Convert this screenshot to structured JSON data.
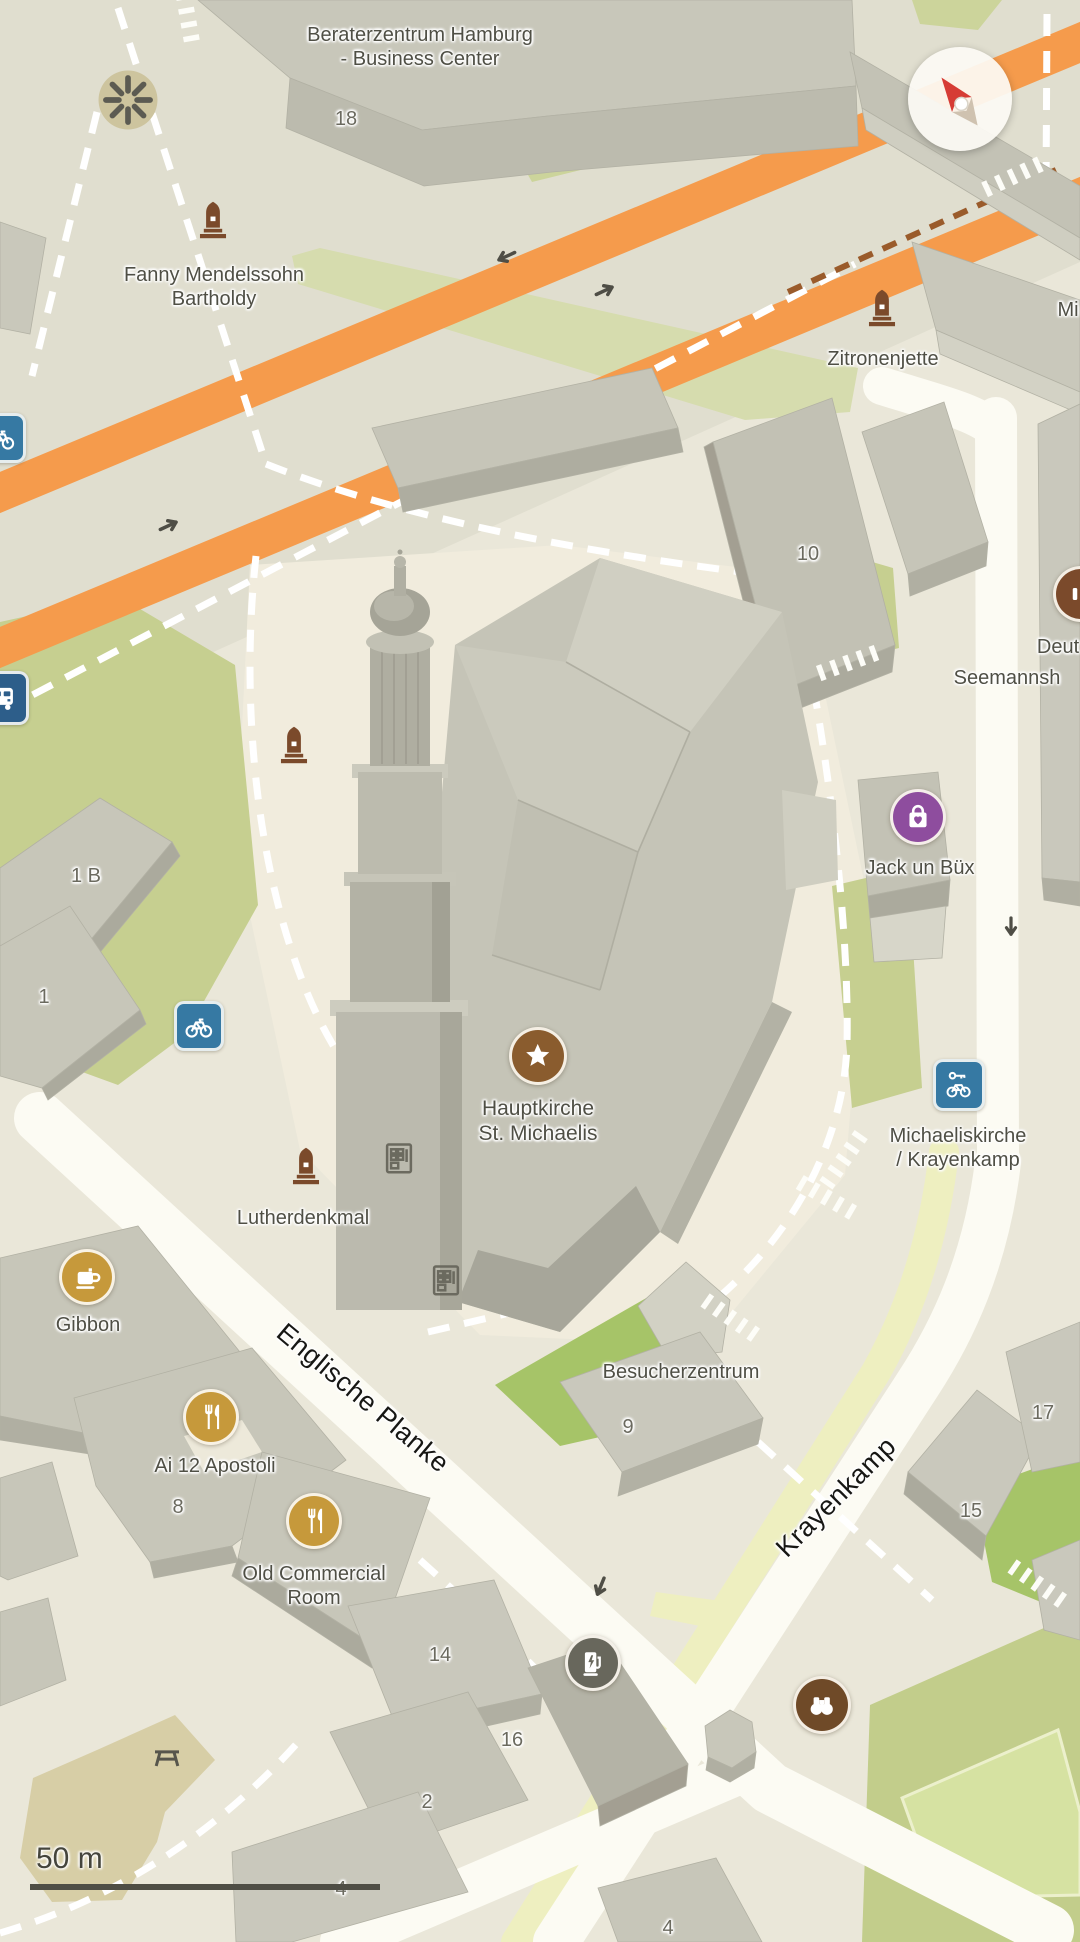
{
  "map": {
    "scale": {
      "label": "50 m"
    },
    "colors": {
      "background": "#EAE7D9",
      "plaza": "#F1ECDD",
      "road_corridor": "#E0DECF",
      "road_white": "#FCFBF3",
      "road_orange": "#F59B4C",
      "path_brown_dashed": "#9A5B2B",
      "green": "#C6CF90",
      "green_bright": "#A6C468",
      "green_field": "#C2CD8B",
      "bike_lane_yellow": "#EEEFC0",
      "building_roof": "#C9C8BB",
      "building_wall": "#B0AFA2",
      "poi_brown": "#8A5C2E",
      "poi_purple": "#8E4D9E",
      "poi_gold": "#C6993B",
      "poi_gray": "#68675C",
      "poi_darkbrown": "#6F4A28",
      "poi_blue": "#3679A3",
      "poi_busblue": "#2D5E8A",
      "memorial_brown": "#7B4A2B",
      "compass_red": "#D63C35"
    },
    "labels": [
      {
        "name": "label-beraterzentrum",
        "text": "Beraterzentrum Hamburg\n- Business Center",
        "x": 420,
        "y": 47,
        "size": 20
      },
      {
        "name": "label-fanny-mendelssohn",
        "text": "Fanny Mendelssohn\nBartholdy",
        "x": 214,
        "y": 287,
        "size": 20
      },
      {
        "name": "label-zitronenjette",
        "text": "Zitronenjette",
        "x": 883,
        "y": 359,
        "size": 20
      },
      {
        "name": "label-mi-partial",
        "text": "Mi",
        "x": 1068,
        "y": 310,
        "size": 20
      },
      {
        "name": "label-deut-partial",
        "text": "Deut",
        "x": 1058,
        "y": 647,
        "size": 20
      },
      {
        "name": "label-seemannsh-partial",
        "text": "Seemannsh",
        "x": 1007,
        "y": 678,
        "size": 20
      },
      {
        "name": "label-jack-un-buex",
        "text": "Jack un Büx",
        "x": 920,
        "y": 868,
        "size": 20
      },
      {
        "name": "label-hauptkirche",
        "text": "Hauptkirche\nSt. Michaelis",
        "x": 538,
        "y": 1121,
        "size": 21
      },
      {
        "name": "label-michaeliskirche",
        "text": "Michaeliskirche\n/ Krayenkamp",
        "x": 958,
        "y": 1148,
        "size": 20
      },
      {
        "name": "label-lutherdenkmal",
        "text": "Lutherdenkmal",
        "x": 303,
        "y": 1218,
        "size": 20
      },
      {
        "name": "label-gibbon",
        "text": "Gibbon",
        "x": 88,
        "y": 1325,
        "size": 20
      },
      {
        "name": "label-besucherzentrum",
        "text": "Besucherzentrum",
        "x": 681,
        "y": 1372,
        "size": 20
      },
      {
        "name": "label-ai-12-apostoli",
        "text": "Ai 12 Apostoli",
        "x": 215,
        "y": 1466,
        "size": 20
      },
      {
        "name": "label-old-commercial-room",
        "text": "Old Commercial\nRoom",
        "x": 314,
        "y": 1586,
        "size": 20
      },
      {
        "name": "street-englische-planke",
        "text": "Englische Planke",
        "x": 363,
        "y": 1398,
        "size": 27,
        "cls": "street",
        "rot": 40
      },
      {
        "name": "street-krayenkamp",
        "text": "Krayenkamp",
        "x": 836,
        "y": 1497,
        "size": 27,
        "cls": "street",
        "rot": -45
      },
      {
        "name": "number-18",
        "text": "18",
        "x": 346,
        "y": 119,
        "size": 20,
        "cls": "num"
      },
      {
        "name": "number-10",
        "text": "10",
        "x": 808,
        "y": 554,
        "size": 20,
        "cls": "num"
      },
      {
        "name": "number-1b",
        "text": "1 B",
        "x": 86,
        "y": 876,
        "size": 20,
        "cls": "num"
      },
      {
        "name": "number-1",
        "text": "1",
        "x": 44,
        "y": 997,
        "size": 20,
        "cls": "num"
      },
      {
        "name": "number-9",
        "text": "9",
        "x": 628,
        "y": 1427,
        "size": 20,
        "cls": "num"
      },
      {
        "name": "number-8",
        "text": "8",
        "x": 178,
        "y": 1507,
        "size": 20,
        "cls": "num"
      },
      {
        "name": "number-14",
        "text": "14",
        "x": 440,
        "y": 1655,
        "size": 20,
        "cls": "num"
      },
      {
        "name": "number-16",
        "text": "16",
        "x": 512,
        "y": 1740,
        "size": 20,
        "cls": "num"
      },
      {
        "name": "number-2",
        "text": "2",
        "x": 427,
        "y": 1802,
        "size": 20,
        "cls": "num"
      },
      {
        "name": "number-4a",
        "text": "4",
        "x": 341,
        "y": 1889,
        "size": 20,
        "cls": "num"
      },
      {
        "name": "number-4b",
        "text": "4",
        "x": 668,
        "y": 1928,
        "size": 20,
        "cls": "num"
      },
      {
        "name": "number-17",
        "text": "17",
        "x": 1043,
        "y": 1413,
        "size": 20,
        "cls": "num"
      },
      {
        "name": "number-15",
        "text": "15",
        "x": 971,
        "y": 1511,
        "size": 20,
        "cls": "num"
      }
    ],
    "pois": [
      {
        "name": "memorial-icon-fanny",
        "icon": "memorial",
        "kind": "plain",
        "color": "#7B4A2B",
        "x": 213,
        "y": 220,
        "size": 46
      },
      {
        "name": "memorial-icon-zitronenjette",
        "icon": "memorial",
        "kind": "plain",
        "color": "#7B4A2B",
        "x": 882,
        "y": 308,
        "size": 46
      },
      {
        "name": "memorial-icon-church-north",
        "icon": "memorial",
        "kind": "plain",
        "color": "#7B4A2B",
        "x": 294,
        "y": 745,
        "size": 46
      },
      {
        "name": "memorial-icon-lutherdenkmal",
        "icon": "memorial",
        "kind": "plain",
        "color": "#7B4A2B",
        "x": 306,
        "y": 1166,
        "size": 46
      },
      {
        "name": "star-poi-icon",
        "icon": "star",
        "kind": "circle",
        "color": "#8A5C2E",
        "x": 538,
        "y": 1056,
        "size": 52
      },
      {
        "name": "shopping-poi-icon",
        "icon": "shopping",
        "kind": "circle",
        "color": "#8E4D9E",
        "x": 918,
        "y": 817,
        "size": 50
      },
      {
        "name": "coffee-poi-icon",
        "icon": "coffee",
        "kind": "circle",
        "color": "#C6993B",
        "x": 87,
        "y": 1277,
        "size": 50
      },
      {
        "name": "restaurant-poi-icon-apostoli",
        "icon": "restaurant",
        "kind": "circle",
        "color": "#C6993B",
        "x": 211,
        "y": 1417,
        "size": 50
      },
      {
        "name": "restaurant-poi-icon-oldcommercial",
        "icon": "restaurant",
        "kind": "circle",
        "color": "#C6993B",
        "x": 314,
        "y": 1521,
        "size": 50
      },
      {
        "name": "ev-charging-poi-icon",
        "icon": "ev",
        "kind": "circle",
        "color": "#68675C",
        "x": 593,
        "y": 1663,
        "size": 50
      },
      {
        "name": "binoculars-poi-icon",
        "icon": "binoculars",
        "kind": "circle",
        "color": "#6F4A28",
        "x": 822,
        "y": 1705,
        "size": 52
      },
      {
        "name": "bike-rental-icon",
        "icon": "bike",
        "kind": "square",
        "color": "#3679A3",
        "x": 199,
        "y": 1026,
        "size": 44
      },
      {
        "name": "bike-rental-key-icon",
        "icon": "bikekey",
        "kind": "square",
        "color": "#3679A3",
        "x": 959,
        "y": 1085,
        "size": 46
      },
      {
        "name": "bus-stop-icon",
        "icon": "bus",
        "kind": "square",
        "color": "#2D5E8A",
        "x": 2,
        "y": 698,
        "size": 48
      },
      {
        "name": "bike-rental-icon-left-edge",
        "icon": "bike",
        "kind": "square",
        "color": "#3679A3",
        "x": 1,
        "y": 438,
        "size": 44
      },
      {
        "name": "poi-icon-partial-right-edge",
        "icon": "partial",
        "kind": "circle",
        "color": "#7B4A2B",
        "x": 1081,
        "y": 594,
        "size": 50
      },
      {
        "name": "roundabout-garden-icon",
        "icon": "roundabout",
        "kind": "plain",
        "x": 128,
        "y": 100,
        "size": 68,
        "interactable": false
      },
      {
        "name": "picnic-table-icon",
        "icon": "picnic",
        "kind": "plain",
        "x": 167,
        "y": 1757,
        "size": 36,
        "interactable": false
      },
      {
        "name": "vending-machine-icon-1",
        "icon": "vending",
        "kind": "plain",
        "x": 399,
        "y": 1158,
        "size": 38
      },
      {
        "name": "vending-machine-icon-2",
        "icon": "vending",
        "kind": "plain",
        "x": 446,
        "y": 1280,
        "size": 38
      },
      {
        "name": "oneway-arrow-icon-1",
        "icon": "arrow",
        "kind": "plain",
        "x": 505,
        "y": 257,
        "size": 32,
        "rot": 155,
        "interactable": false
      },
      {
        "name": "oneway-arrow-icon-2",
        "icon": "arrow",
        "kind": "plain",
        "x": 606,
        "y": 290,
        "size": 32,
        "rot": -25,
        "interactable": false
      },
      {
        "name": "oneway-arrow-icon-3",
        "icon": "arrow",
        "kind": "plain",
        "x": 170,
        "y": 525,
        "size": 32,
        "rot": -25,
        "interactable": false
      },
      {
        "name": "oneway-arrow-icon-4",
        "icon": "arrow",
        "kind": "plain",
        "x": 600,
        "y": 1588,
        "size": 32,
        "rot": 112,
        "interactable": false
      },
      {
        "name": "oneway-arrow-icon-5",
        "icon": "arrow",
        "kind": "plain",
        "x": 1011,
        "y": 928,
        "size": 30,
        "rot": 90,
        "interactable": false
      }
    ]
  }
}
